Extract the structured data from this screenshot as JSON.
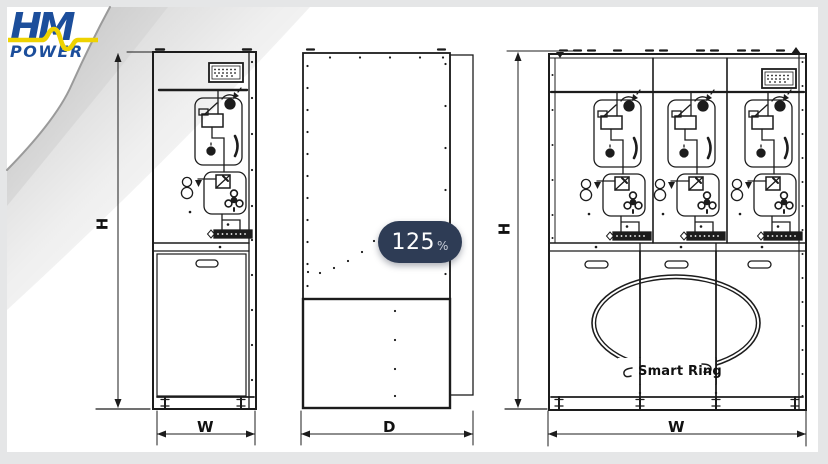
{
  "logo": {
    "line1": "HM",
    "line2": "POWER"
  },
  "zoom_badge": {
    "value": "125",
    "unit": "%"
  },
  "drawing": {
    "labels": {
      "height": "H",
      "width": "W",
      "depth": "D"
    },
    "annotations": {
      "ring": "Smart Ring"
    }
  },
  "colors": {
    "logo_blue": "#1c4e9b",
    "logo_yellow": "#eed200",
    "badge_bg": "#2e3c55",
    "line": "#1c1c1c",
    "background": "#e5e6e7",
    "paper": "#ffffff"
  }
}
